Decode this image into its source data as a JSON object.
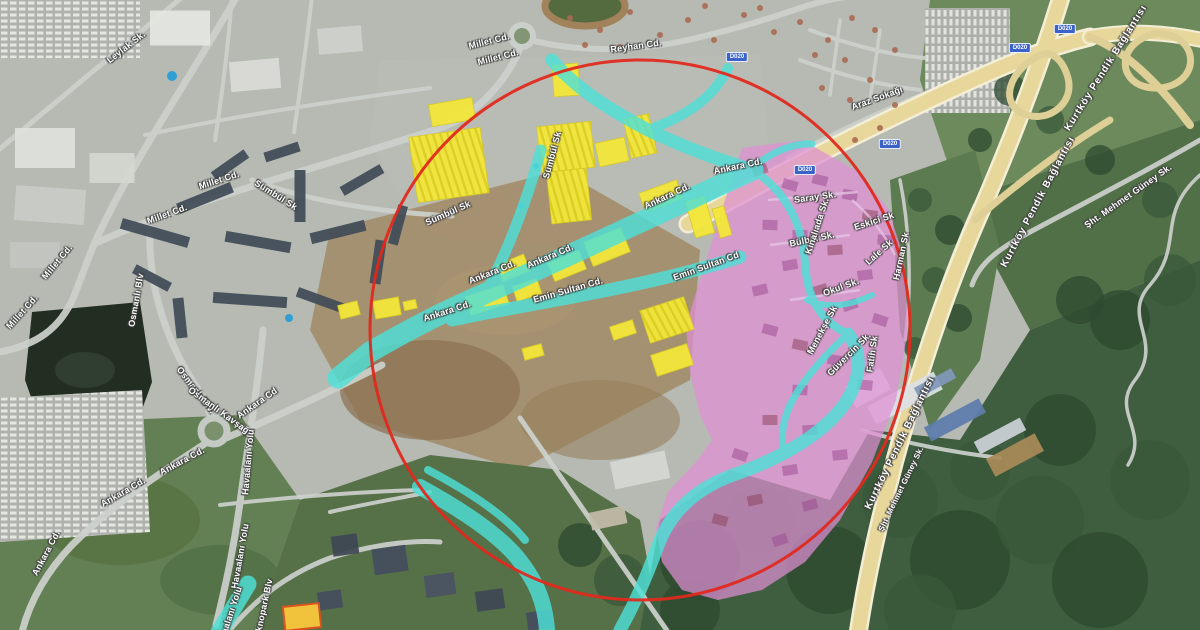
{
  "map": {
    "view_type": "satellite",
    "overlay_colors": {
      "selection_circle": "#e0291d",
      "highlighted_roads": "#4ee0d8",
      "highlighted_buildings": "#f4e73a",
      "highlighted_district": "#df8fd4",
      "highway": "#e7d79b",
      "road_shield_bg": "#3a62c8"
    },
    "road_shield": {
      "text": "D020"
    },
    "shield_positions": [
      {
        "x": 737,
        "y": 57
      },
      {
        "x": 805,
        "y": 170
      },
      {
        "x": 890,
        "y": 144
      },
      {
        "x": 1020,
        "y": 48
      },
      {
        "x": 1065,
        "y": 29
      }
    ],
    "labels": [
      {
        "text": "Leylak Sk.",
        "x": 126,
        "y": 47,
        "r": -38
      },
      {
        "text": "Millet Cd.",
        "x": 489,
        "y": 41,
        "r": -14
      },
      {
        "text": "Millet Cd.",
        "x": 498,
        "y": 57,
        "r": -14
      },
      {
        "text": "Reyhan Cd.",
        "x": 636,
        "y": 46,
        "r": -8
      },
      {
        "text": "Millet Cd.",
        "x": 219,
        "y": 180,
        "r": -18
      },
      {
        "text": "Millet Cd.",
        "x": 167,
        "y": 214,
        "r": -20
      },
      {
        "text": "Millet Cd.",
        "x": 57,
        "y": 262,
        "r": -50
      },
      {
        "text": "Millet Cd.",
        "x": 22,
        "y": 312,
        "r": -48
      },
      {
        "text": "Sümbül Sk",
        "x": 276,
        "y": 195,
        "r": 32
      },
      {
        "text": "Sümbül Sk",
        "x": 448,
        "y": 213,
        "r": -24
      },
      {
        "text": "Sümbül Sk",
        "x": 552,
        "y": 155,
        "r": -75
      },
      {
        "text": "Ankara Cd.",
        "x": 667,
        "y": 196,
        "r": -25
      },
      {
        "text": "Ankara Cd.",
        "x": 550,
        "y": 256,
        "r": -23
      },
      {
        "text": "Ankara Cd.",
        "x": 492,
        "y": 272,
        "r": -22
      },
      {
        "text": "Ankara Cd.",
        "x": 447,
        "y": 311,
        "r": -18
      },
      {
        "text": "Ankara Cd.",
        "x": 738,
        "y": 166,
        "r": -12
      },
      {
        "text": "Ankara Cd",
        "x": 257,
        "y": 403,
        "r": -35
      },
      {
        "text": "Ankara Cd.",
        "x": 182,
        "y": 461,
        "r": -28
      },
      {
        "text": "Ankara Cd.",
        "x": 123,
        "y": 492,
        "r": -30
      },
      {
        "text": "Ankara Cd.",
        "x": 46,
        "y": 553,
        "r": -62
      },
      {
        "text": "Osmanlı Blv",
        "x": 136,
        "y": 300,
        "r": -80
      },
      {
        "text": "Osmanlı Blv.",
        "x": 196,
        "y": 390,
        "r": 52
      },
      {
        "text": "Osmanlı Kavşağı",
        "x": 220,
        "y": 411,
        "r": 36
      },
      {
        "text": "Havaalanı Yolu",
        "x": 248,
        "y": 462,
        "r": -85
      },
      {
        "text": "Havaalanı Yolu",
        "x": 240,
        "y": 556,
        "r": -80
      },
      {
        "text": "Havaalanı Yolu",
        "x": 229,
        "y": 618,
        "r": -72
      },
      {
        "text": "Teknopark Blv",
        "x": 263,
        "y": 610,
        "r": -78
      },
      {
        "text": "Emin Sultan Cd.",
        "x": 568,
        "y": 290,
        "r": -16
      },
      {
        "text": "Emin Sultan Cd",
        "x": 706,
        "y": 266,
        "r": -20
      },
      {
        "text": "Araz Sokağı",
        "x": 877,
        "y": 98,
        "r": -20
      },
      {
        "text": "Saray Sk.",
        "x": 815,
        "y": 197,
        "r": -8
      },
      {
        "text": "Eskici Sk",
        "x": 874,
        "y": 221,
        "r": -18
      },
      {
        "text": "Bülbül Sk.",
        "x": 812,
        "y": 239,
        "r": -12
      },
      {
        "text": "Lale Sk",
        "x": 879,
        "y": 252,
        "r": -42
      },
      {
        "text": "Okul Sk.",
        "x": 841,
        "y": 287,
        "r": -20
      },
      {
        "text": "Menekşe Sk",
        "x": 822,
        "y": 330,
        "r": -62
      },
      {
        "text": "Güvercin Sk.",
        "x": 849,
        "y": 354,
        "r": -45
      },
      {
        "text": "Fatih Sk",
        "x": 872,
        "y": 354,
        "r": -82
      },
      {
        "text": "Harman Sk",
        "x": 901,
        "y": 256,
        "r": -78
      },
      {
        "text": "Kınalıada Sk.",
        "x": 817,
        "y": 226,
        "r": -72
      },
      {
        "text": "Kurtköy Pendik Bağlantısı",
        "x": 1106,
        "y": 68,
        "r": -58,
        "cls": "hwy"
      },
      {
        "text": "Kurtköy Pendik Bağlantısı",
        "x": 1038,
        "y": 202,
        "r": -62,
        "cls": "hwy"
      },
      {
        "text": "Kurtköy Pendik Bağlantısı",
        "x": 900,
        "y": 443,
        "r": -64,
        "cls": "hwy"
      },
      {
        "text": "Şht. Mehmet Güney Sk.",
        "x": 1128,
        "y": 196,
        "r": -35
      },
      {
        "text": "Şht. Mehmet Güney Sk.",
        "x": 901,
        "y": 489,
        "r": -64,
        "s": 8
      }
    ]
  }
}
